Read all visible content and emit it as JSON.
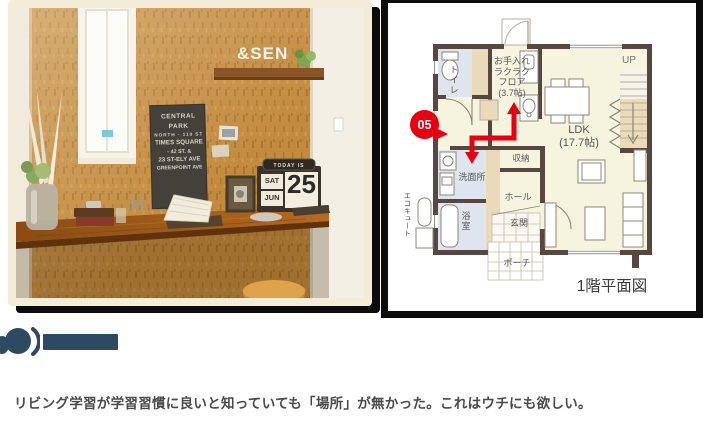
{
  "page": {
    "background": "#ffffff"
  },
  "colors": {
    "accent_red": "#e60012",
    "navy": "#2e4a63",
    "wall": "#564840",
    "floor_cream": "#f6f3de",
    "room_blue": "#dfe5ee",
    "beige": "#eadaba",
    "frame_black": "#0c0c0c",
    "photo_mat_cream": "#f2ecd9"
  },
  "photo": {
    "description": "Study nook with cork wall, window and wooden counter desk",
    "sign_lines": [
      "CENTRAL PARK",
      "NORTH - 110 ST",
      "TIMES SQUARE",
      "- 42 ST. &",
      "23 ST-ELY AVE",
      "GREENPOINT AVE"
    ],
    "calendar": {
      "banner": "TODAY IS",
      "day": "SAT",
      "month": "JUN",
      "date": "25"
    },
    "shelf_letters": "&SEN",
    "desk_letter": "H"
  },
  "floor_plan": {
    "title": "1階平面図",
    "badge": "05",
    "stairs_label": "UP",
    "rooms": {
      "toilet": "トイレ",
      "utility_l1": "お手入れ",
      "utility_l2": "ラクラク",
      "utility_l3": "フロア",
      "utility_l4": "(3.7帖)",
      "ldk_l1": "LDK",
      "ldk_l2": "(17.7帖)",
      "storage": "収納",
      "washroom": "洗面所",
      "hall": "ホール",
      "entrance": "玄関",
      "bath": "浴室",
      "porch": "ポーチ",
      "water_heater": "エコキュート"
    }
  },
  "comment": {
    "text": "リビング学習が学習習慣に良いと知っていても「場所」が無かった。これはウチにも欲しい。"
  }
}
